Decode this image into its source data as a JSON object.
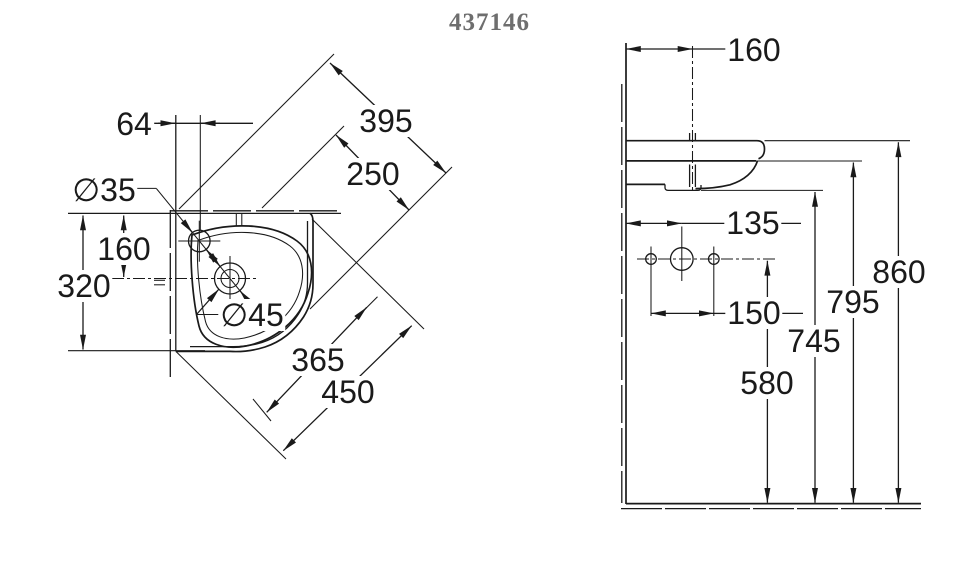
{
  "title": "437146",
  "colors": {
    "line": "#1a1a1a",
    "title_gray": "#6e6e6e",
    "background": "#ffffff"
  },
  "plan_view": {
    "description": "corner washbasin plan view",
    "dims": {
      "tap_offset": "64",
      "rim_diagonal": "395",
      "drain_diagonal": "250",
      "tap_diameter": "∅35",
      "drain_from_wall": "160",
      "side_depth": "320",
      "drain_diameter": "∅45",
      "bowl_diagonal": "365",
      "overall_diagonal": "450"
    }
  },
  "side_view": {
    "description": "corner washbasin side elevation",
    "dims": {
      "tap_from_wall": "160",
      "fixing_from_wall": "135",
      "fixing_spacing": "150",
      "fixing_height": "580",
      "underside_height": "745",
      "apron_height": "795",
      "rim_height": "860"
    }
  }
}
